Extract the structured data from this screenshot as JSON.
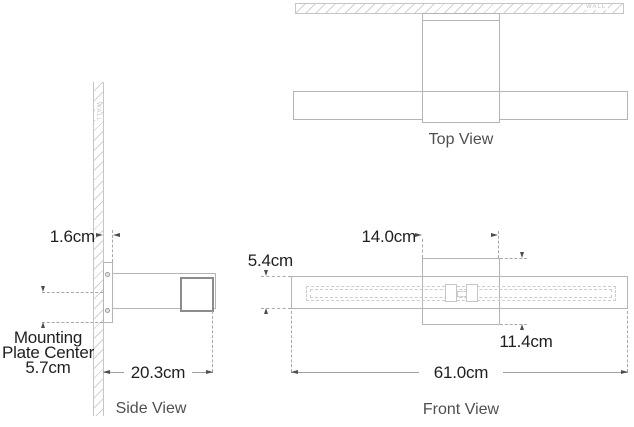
{
  "top_view": {
    "caption": "Top View",
    "wall_label": "WALL"
  },
  "side_view": {
    "caption": "Side View",
    "wall_label": "WALL",
    "dim_plate_thickness": "1.6cm",
    "dim_projection": "20.3cm",
    "mount_label": [
      "Mounting",
      "Plate Center",
      "5.7cm"
    ]
  },
  "front_view": {
    "caption": "Front View",
    "dim_backplate_width": "14.0cm",
    "dim_bar_height": "5.4cm",
    "dim_backplate_height": "11.4cm",
    "dim_overall_width": "61.0cm"
  },
  "colors": {
    "drawing_line": "#b4b4b4",
    "bar_section_line": "#8c8c8c",
    "hatch": "#d2d2d2",
    "dashed_line": "#a8a8a8",
    "arrow": "#4d4d4d",
    "dimension_text": "#1f1f1f",
    "caption_text": "#4f4f4f",
    "wall_text": "#c0c0c0",
    "background": "#ffffff"
  }
}
